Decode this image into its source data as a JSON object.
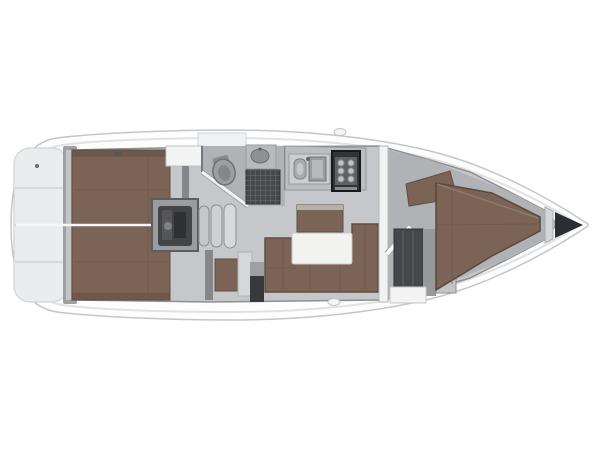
{
  "page": {
    "background": "#ffffff"
  },
  "boat": {
    "view": "top-down-floorplan",
    "orientation": "bow-right",
    "colors": {
      "hull": "#fdfdfd",
      "hull_outline": "#c3c6c9",
      "platform": "#ebecee",
      "platform_dark": "#9fa0a3",
      "floor": "#c6c7ca",
      "floor_dark": "#b1b2b5",
      "wall": "#85868a",
      "wood": "#7b6355",
      "wood_dark": "#5d4b40",
      "white_furniture": "#f3f4f3",
      "table": "#f2f2f0",
      "engine": "#434447",
      "equipment_dark": "#38393c",
      "shower_grate": "#47484c",
      "stove": "#323337",
      "wardrobe": "#46474b",
      "anchor_locker": "#2c2d30",
      "centerline": "#f7f7f7",
      "seat_gray": "#d6d7d9",
      "counter": "#bcbdc0",
      "sink_unit": "#cdced1",
      "steps": "#c6c7ca"
    },
    "rooms": [
      {
        "id": "stern-platform"
      },
      {
        "id": "aft-cabin-port"
      },
      {
        "id": "aft-cabin-starboard"
      },
      {
        "id": "engine-compartment"
      },
      {
        "id": "companionway-steps"
      },
      {
        "id": "heads-with-shower"
      },
      {
        "id": "galley"
      },
      {
        "id": "saloon"
      },
      {
        "id": "nav-station"
      },
      {
        "id": "forward-cabin"
      },
      {
        "id": "anchor-locker"
      }
    ]
  }
}
